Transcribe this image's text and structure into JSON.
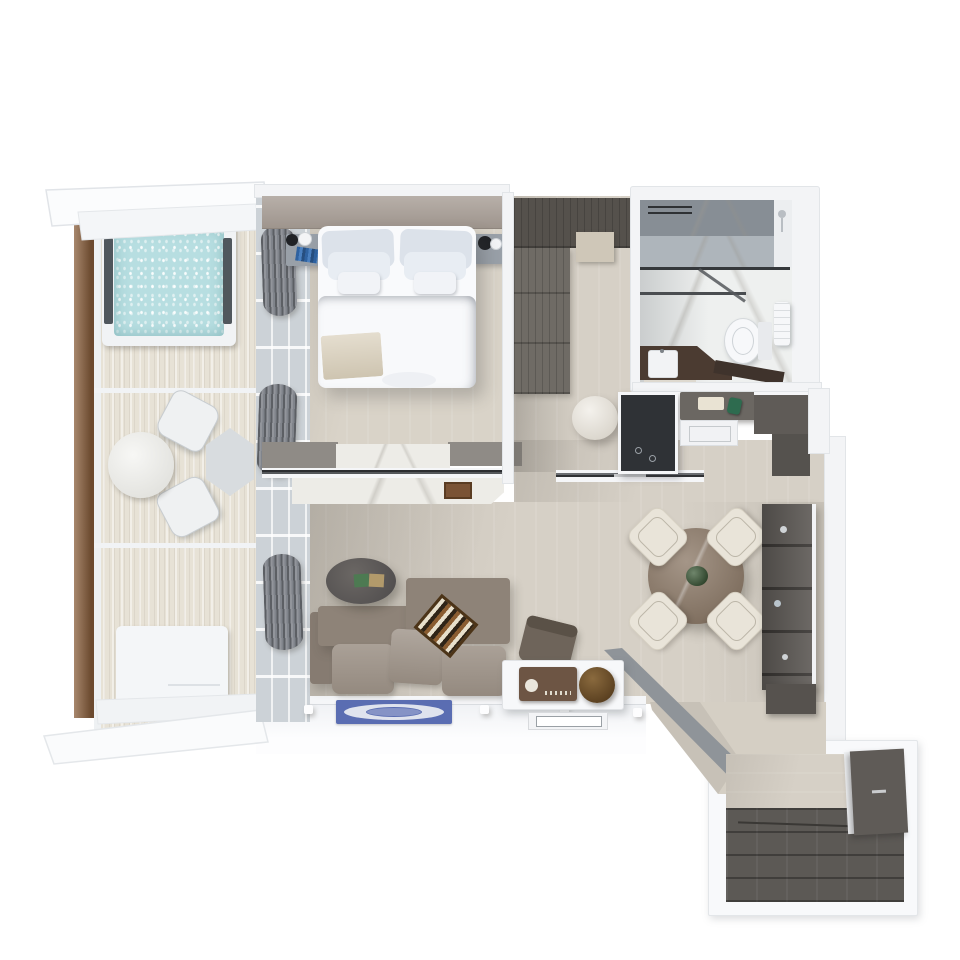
{
  "scene": {
    "type": "3d-floor-plan-top-view",
    "subject": "hotel-suite-with-balcony",
    "background": "#ffffff"
  },
  "colors": {
    "background": "#ffffff",
    "wall": "#f3f4f6",
    "wall_edge": "#dde0e4",
    "rail_wood": "#8a5f3c",
    "deck_wood": "#e7e2d6",
    "water": "#b7dee1",
    "glass_wall": "#ccd2d7",
    "curtain": "#80848b",
    "headboard_wall": "#a89e96",
    "interior_floor": "#d6d0c6",
    "bedroom_floor": "#d9d3c8",
    "marble": "#edece7",
    "wardrobe": "#6f6b65",
    "wardrobe_dark": "#55514c",
    "pouf": "#e9e4da",
    "mirror_dark": "#2f3236",
    "console_dark": "#6b6762",
    "tray_green": "#2e6b4f",
    "shower_marble": "#878e95",
    "shower_marble_light": "#aeb5bb",
    "vanity_counter": "#4b3b31",
    "sofa": "#8e8378",
    "sofa_cushion": "#9c9186",
    "backgammon_frame": "#4c3418",
    "coffee_table": "#5f5b58",
    "rug_blue": "#5a6db2",
    "rug_light": "#dfe3ee",
    "dining_table": "#8b7866",
    "chair_cream": "#e9e4d9",
    "plant_green": "#3f5d3a",
    "bookshelf": "#605c58",
    "desk_white": "#f7f8fa",
    "radio_brown": "#6d5544",
    "bowl_brown": "#7c5c35",
    "entry_floor_dark": "#5c5955",
    "sideboard_dark": "#5f5b57",
    "curb_gray": "#8f9499",
    "bed_white": "#f9fafc",
    "pillow_gray": "#dce2ea",
    "throw_beige": "#d9cfba",
    "nightstand": "#99a0a8",
    "books_blue": "#3a6ea8",
    "toilet_white": "#f7f8fa",
    "towel_white": "#f6f7f9"
  },
  "rooms": {
    "balcony": {
      "name": "balcony-terrace",
      "items": [
        "jacuzzi",
        "outdoor-round-table",
        "outdoor-chairs",
        "hexagonal-side-table",
        "daybed",
        "wood-railing",
        "deck-floor",
        "roof-ledges"
      ]
    },
    "bedroom": {
      "name": "bedroom",
      "items": [
        "king-bed",
        "pillows",
        "throw-blanket",
        "nightstand-left",
        "lamp",
        "books",
        "nightstand-right",
        "headboard-wall",
        "marble-tv-console",
        "glass-partition"
      ]
    },
    "closet": {
      "name": "walk-in-closet",
      "items": [
        "wardrobe",
        "top-cabinet",
        "bench-shelf",
        "round-pouf",
        "mirror-panel",
        "sliding-door"
      ]
    },
    "bathroom": {
      "name": "bathroom",
      "items": [
        "shower",
        "glass-screen",
        "toilet",
        "vanity-counter",
        "sink",
        "towel"
      ]
    },
    "hall": {
      "name": "entry-hall",
      "items": [
        "console-cabinet",
        "decor-tray",
        "green-glass-decor",
        "corner-cabinet"
      ]
    },
    "living": {
      "name": "living-dining-room",
      "items": [
        "corner-sofa",
        "backgammon-board",
        "coffee-table",
        "decor-boxes",
        "area-rug",
        "desk",
        "desk-chair",
        "radio",
        "decor-bowl",
        "dining-table",
        "dining-chairs",
        "plant-centerpiece",
        "bookshelf"
      ]
    },
    "entrance": {
      "name": "entrance-foyer",
      "items": [
        "corridor",
        "curb-wall",
        "dark-wood-floor",
        "sideboard"
      ]
    }
  }
}
